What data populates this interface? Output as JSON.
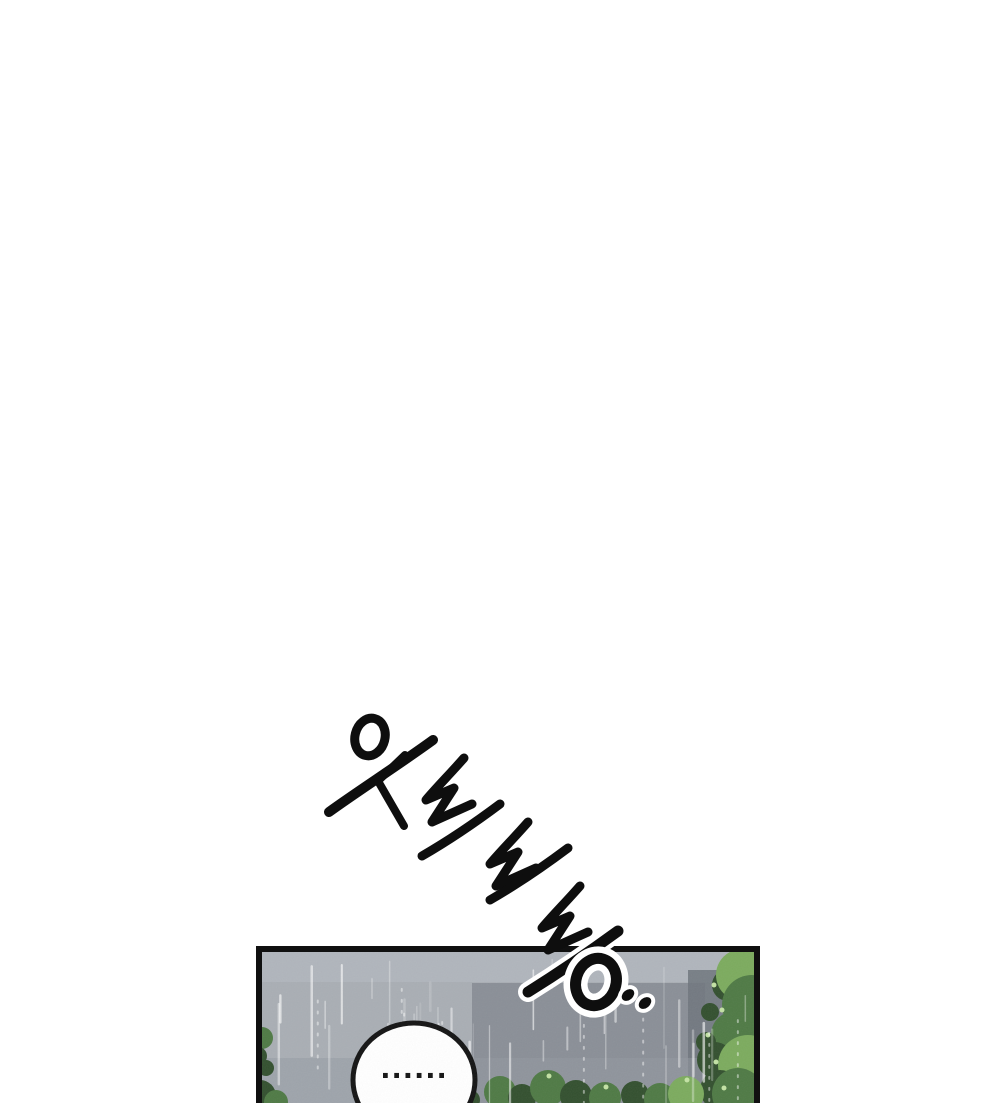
{
  "page": {
    "kind": "webtoon-comic-page",
    "background_color": "#ffffff"
  },
  "palette": {
    "ink": "#0e0e0e",
    "panel_border": "#101010",
    "sky": "#a9aeb4",
    "sky_light": "#b2b7be",
    "building": "#868c94",
    "building_dark": "#6f757d",
    "ground_mist": "#949aa2",
    "rain": "#ffffff",
    "bubble_fill": "#ffffff",
    "bubble_stroke": "#141414",
    "foliage_dark": "#33502f",
    "foliage_mid": "#4f7a45",
    "foliage_bright": "#7cab5e",
    "foliage_highlight": "#c3e2a4"
  },
  "sfx": {
    "text": "쏴아아아..",
    "romanized": "sswaaaa..",
    "description": "hand-drawn diagonal rain sound-effect lettering"
  },
  "panel": {
    "description": "rainy street scene with trees and building silhouette",
    "speech_bubble": {
      "text": "......"
    }
  }
}
